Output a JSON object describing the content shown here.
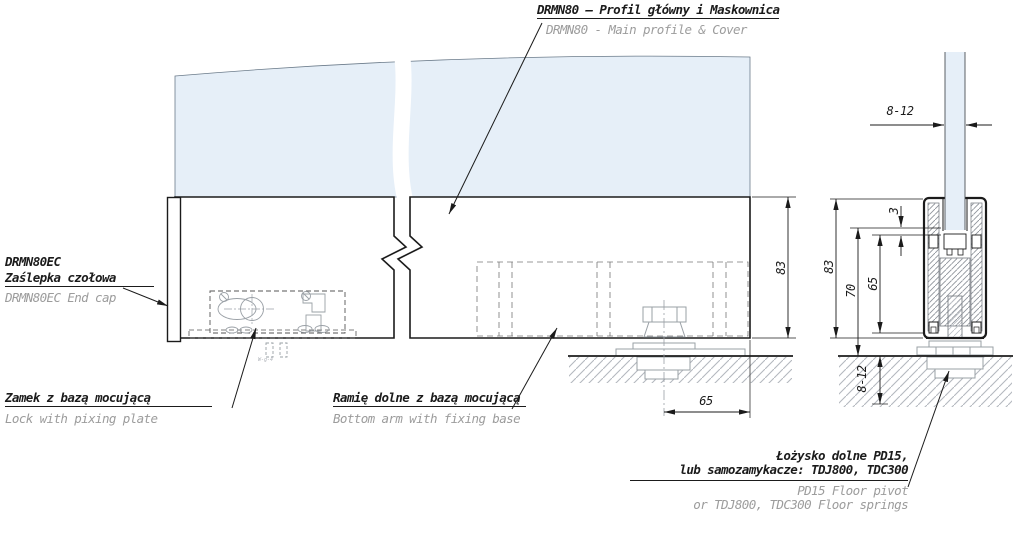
{
  "title": {
    "pl": "DRMN80 – Profil główny i Maskownica",
    "en": "DRMN80 - Main profile & Cover"
  },
  "callouts": {
    "end_cap": {
      "pl1": "DRMN80EC",
      "pl2": "Zaślepka czołowa",
      "en": "DRMN80EC End cap"
    },
    "lock": {
      "pl": "Zamek z bazą mocującą",
      "en": "Lock with pixing plate"
    },
    "bottom_arm": {
      "pl": "Ramię dolne z bazą mocującą",
      "en": "Bottom arm with fixing base"
    },
    "floor_pivot": {
      "pl1": "Łożysko dolne PD15,",
      "pl2": "lub samozamykacze: TDJ800, TDC300",
      "en1": "PD15 Floor pivot",
      "en2": "or TDJ800, TDC300 Floor springs"
    }
  },
  "dimensions": {
    "glass_thickness_top": "8-12",
    "profile_height_main": "83",
    "profile_height_detail": "83",
    "height_70": "70",
    "height_65": "65",
    "glass_inset_3": "3",
    "floor_recess": "8-12",
    "pivot_offset_65": "65"
  },
  "tiny_note": "W-g-4",
  "colors": {
    "glass": "#e6eff8",
    "line": "#1b1b1b",
    "secondary_text": "#9c9c9c",
    "gray_line": "#a9adb3"
  }
}
